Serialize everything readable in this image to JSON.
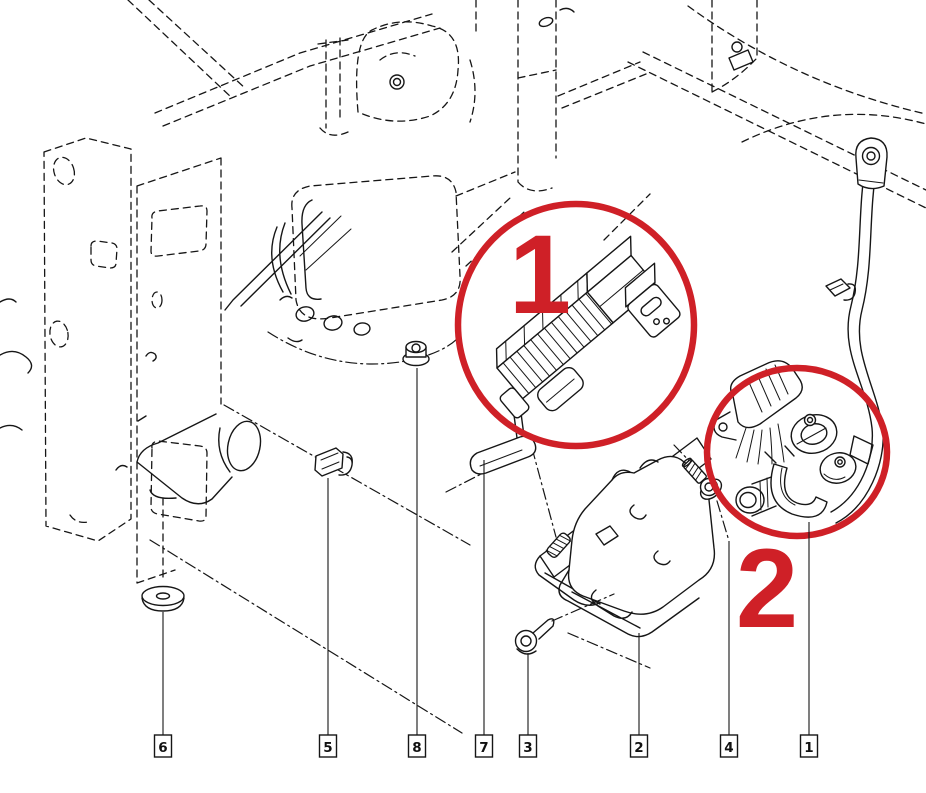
{
  "figure": {
    "type": "exploded-parts-diagram",
    "background": "#ffffff",
    "line_color": "#161616",
    "accent_red": "#cf2027"
  },
  "highlights": [
    {
      "label": "1"
    },
    {
      "label": "2"
    }
  ],
  "callouts": [
    {
      "label": "6"
    },
    {
      "label": "5"
    },
    {
      "label": "8"
    },
    {
      "label": "7"
    },
    {
      "label": "3"
    },
    {
      "label": "2"
    },
    {
      "label": "4"
    },
    {
      "label": "1"
    }
  ]
}
